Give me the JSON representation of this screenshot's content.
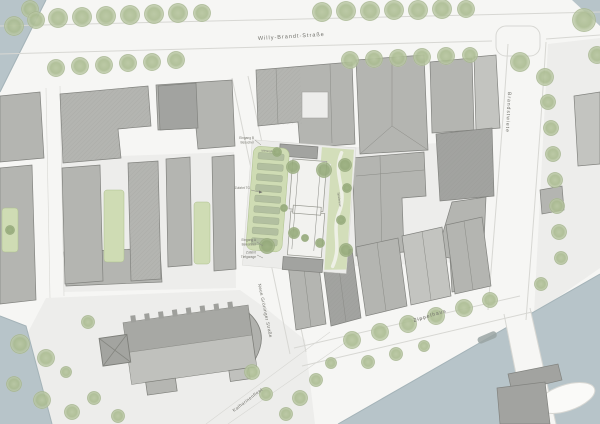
{
  "palette": {
    "street": "#f6f6f4",
    "plaza": "#ededeb",
    "sidewalk_line": "#d7d7d3",
    "water": "#b7c4c9",
    "water_edge": "#a4b3b8",
    "building": "#b4b5b1",
    "building_dark": "#a2a3a0",
    "building_light": "#c3c4c0",
    "building_stroke": "#82837f",
    "new_building": "#f2f2ef",
    "green_light": "#cfdcb4",
    "green_lawn": "#d3deba",
    "bed": "#b2bfa0",
    "tree": "#aabb90",
    "tree_dark": "#93a878",
    "label": "#6e6e68"
  },
  "streets": {
    "willy_brandt": "Willy-Brandt-Straße",
    "brandstwiete": "Brandstwiete",
    "neue_groeninger": "Neue Gröninger Straße",
    "zippelhaus": "Zippelhaus",
    "katharinenfleet": "Katharinenfleet"
  },
  "annotations": {
    "entrance_b_line1": "Eingang B",
    "entrance_b_line2": "Besucher",
    "access_tg": "Zufahrt TG",
    "entrance_a_line1": "Eingang A",
    "entrance_a_line2": "Bewohner",
    "garage_line1": "Zufahrt",
    "garage_line2": "Tiefgarage",
    "garden_strip": "Mietergärten",
    "lawn": "Spielwiese"
  }
}
